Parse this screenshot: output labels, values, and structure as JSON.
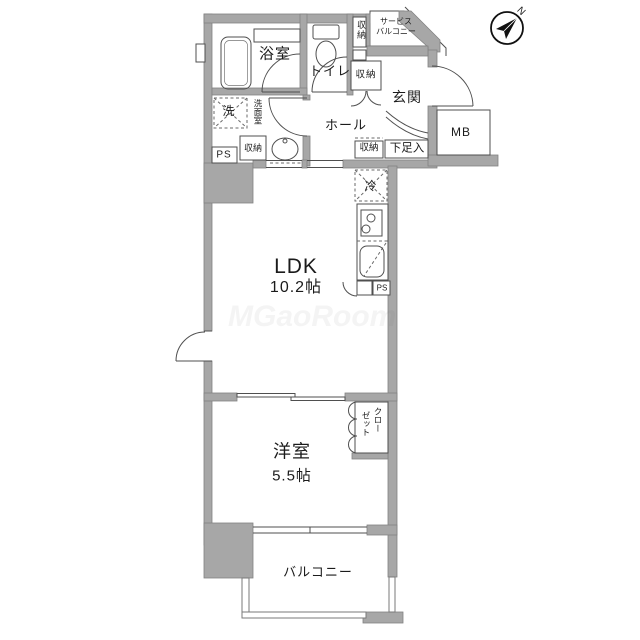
{
  "floorplan": {
    "compass": {
      "north": "N"
    },
    "watermark": "MGaoRoom",
    "labels": {
      "bathroom": "浴室",
      "toilet": "トイレ",
      "storage_top": "収納",
      "service_balcony_1": "サービス",
      "service_balcony_2": "バルコニー",
      "storage_entry": "収納",
      "entrance": "玄関",
      "hall": "ホール",
      "shoe_cabinet": "下足入",
      "meter_box": "MB",
      "laundry": "洗",
      "washroom": "洗面室",
      "storage_washroom": "収納",
      "pipe_space_washroom": "PS",
      "storage_hall": "収納",
      "refrigerator": "冷",
      "pipe_space_kitchen": "PS",
      "ldk_name": "LDK",
      "ldk_size": "10.2帖",
      "western_room_name": "洋室",
      "western_room_size": "5.5帖",
      "closet_line_1": "クロー",
      "closet_line_2": "ゼット",
      "balcony": "バルコニー"
    }
  }
}
